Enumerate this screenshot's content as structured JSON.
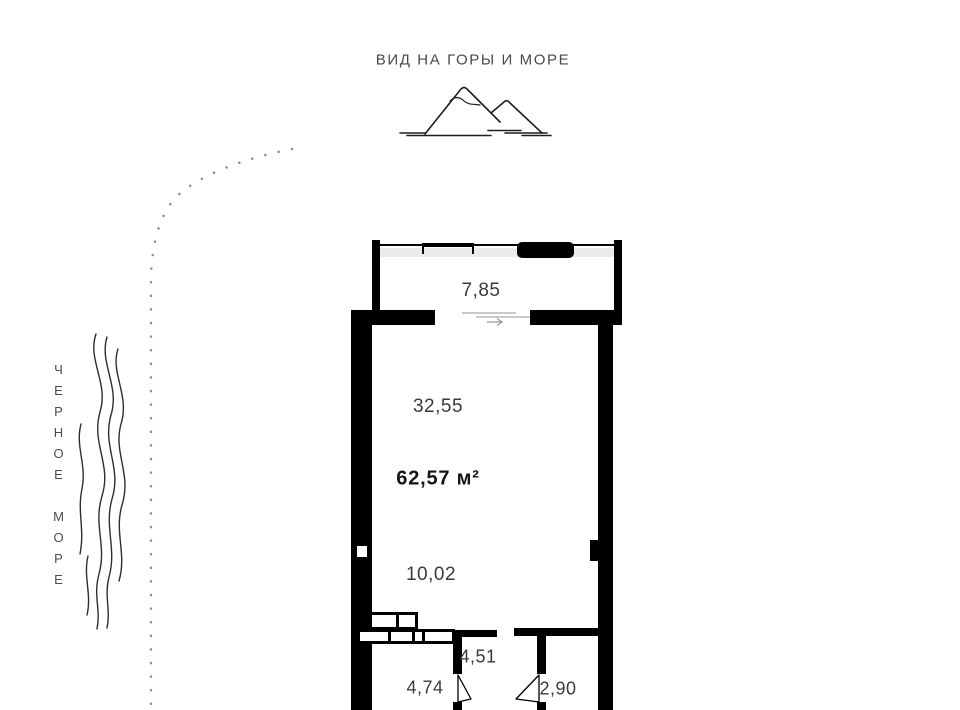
{
  "title": {
    "view_label": "ВИД НА ГОРЫ И МОРЕ"
  },
  "sea": {
    "label": "ЧЕРНОЕ МОРЕ"
  },
  "plan": {
    "total_area": "62,57 м²",
    "areas": {
      "balcony": "7,85",
      "living_room": "32,55",
      "kitchen": "10,02",
      "hallway": "4,51",
      "bathroom": "4,74",
      "storeroom": "2,90"
    }
  },
  "icons": {
    "mountains": "mountains-sketch",
    "sea_waves": "wavy-water-lines",
    "shoreline": "dotted-shoreline",
    "slide_arrow": "arrow-right"
  },
  "colors": {
    "wall": "#000000",
    "glazing": "#ebebeb",
    "label_text": "#3a3a3a",
    "muted_line": "#b8b8b8",
    "shoreline_dots": "#8f8f8f"
  }
}
